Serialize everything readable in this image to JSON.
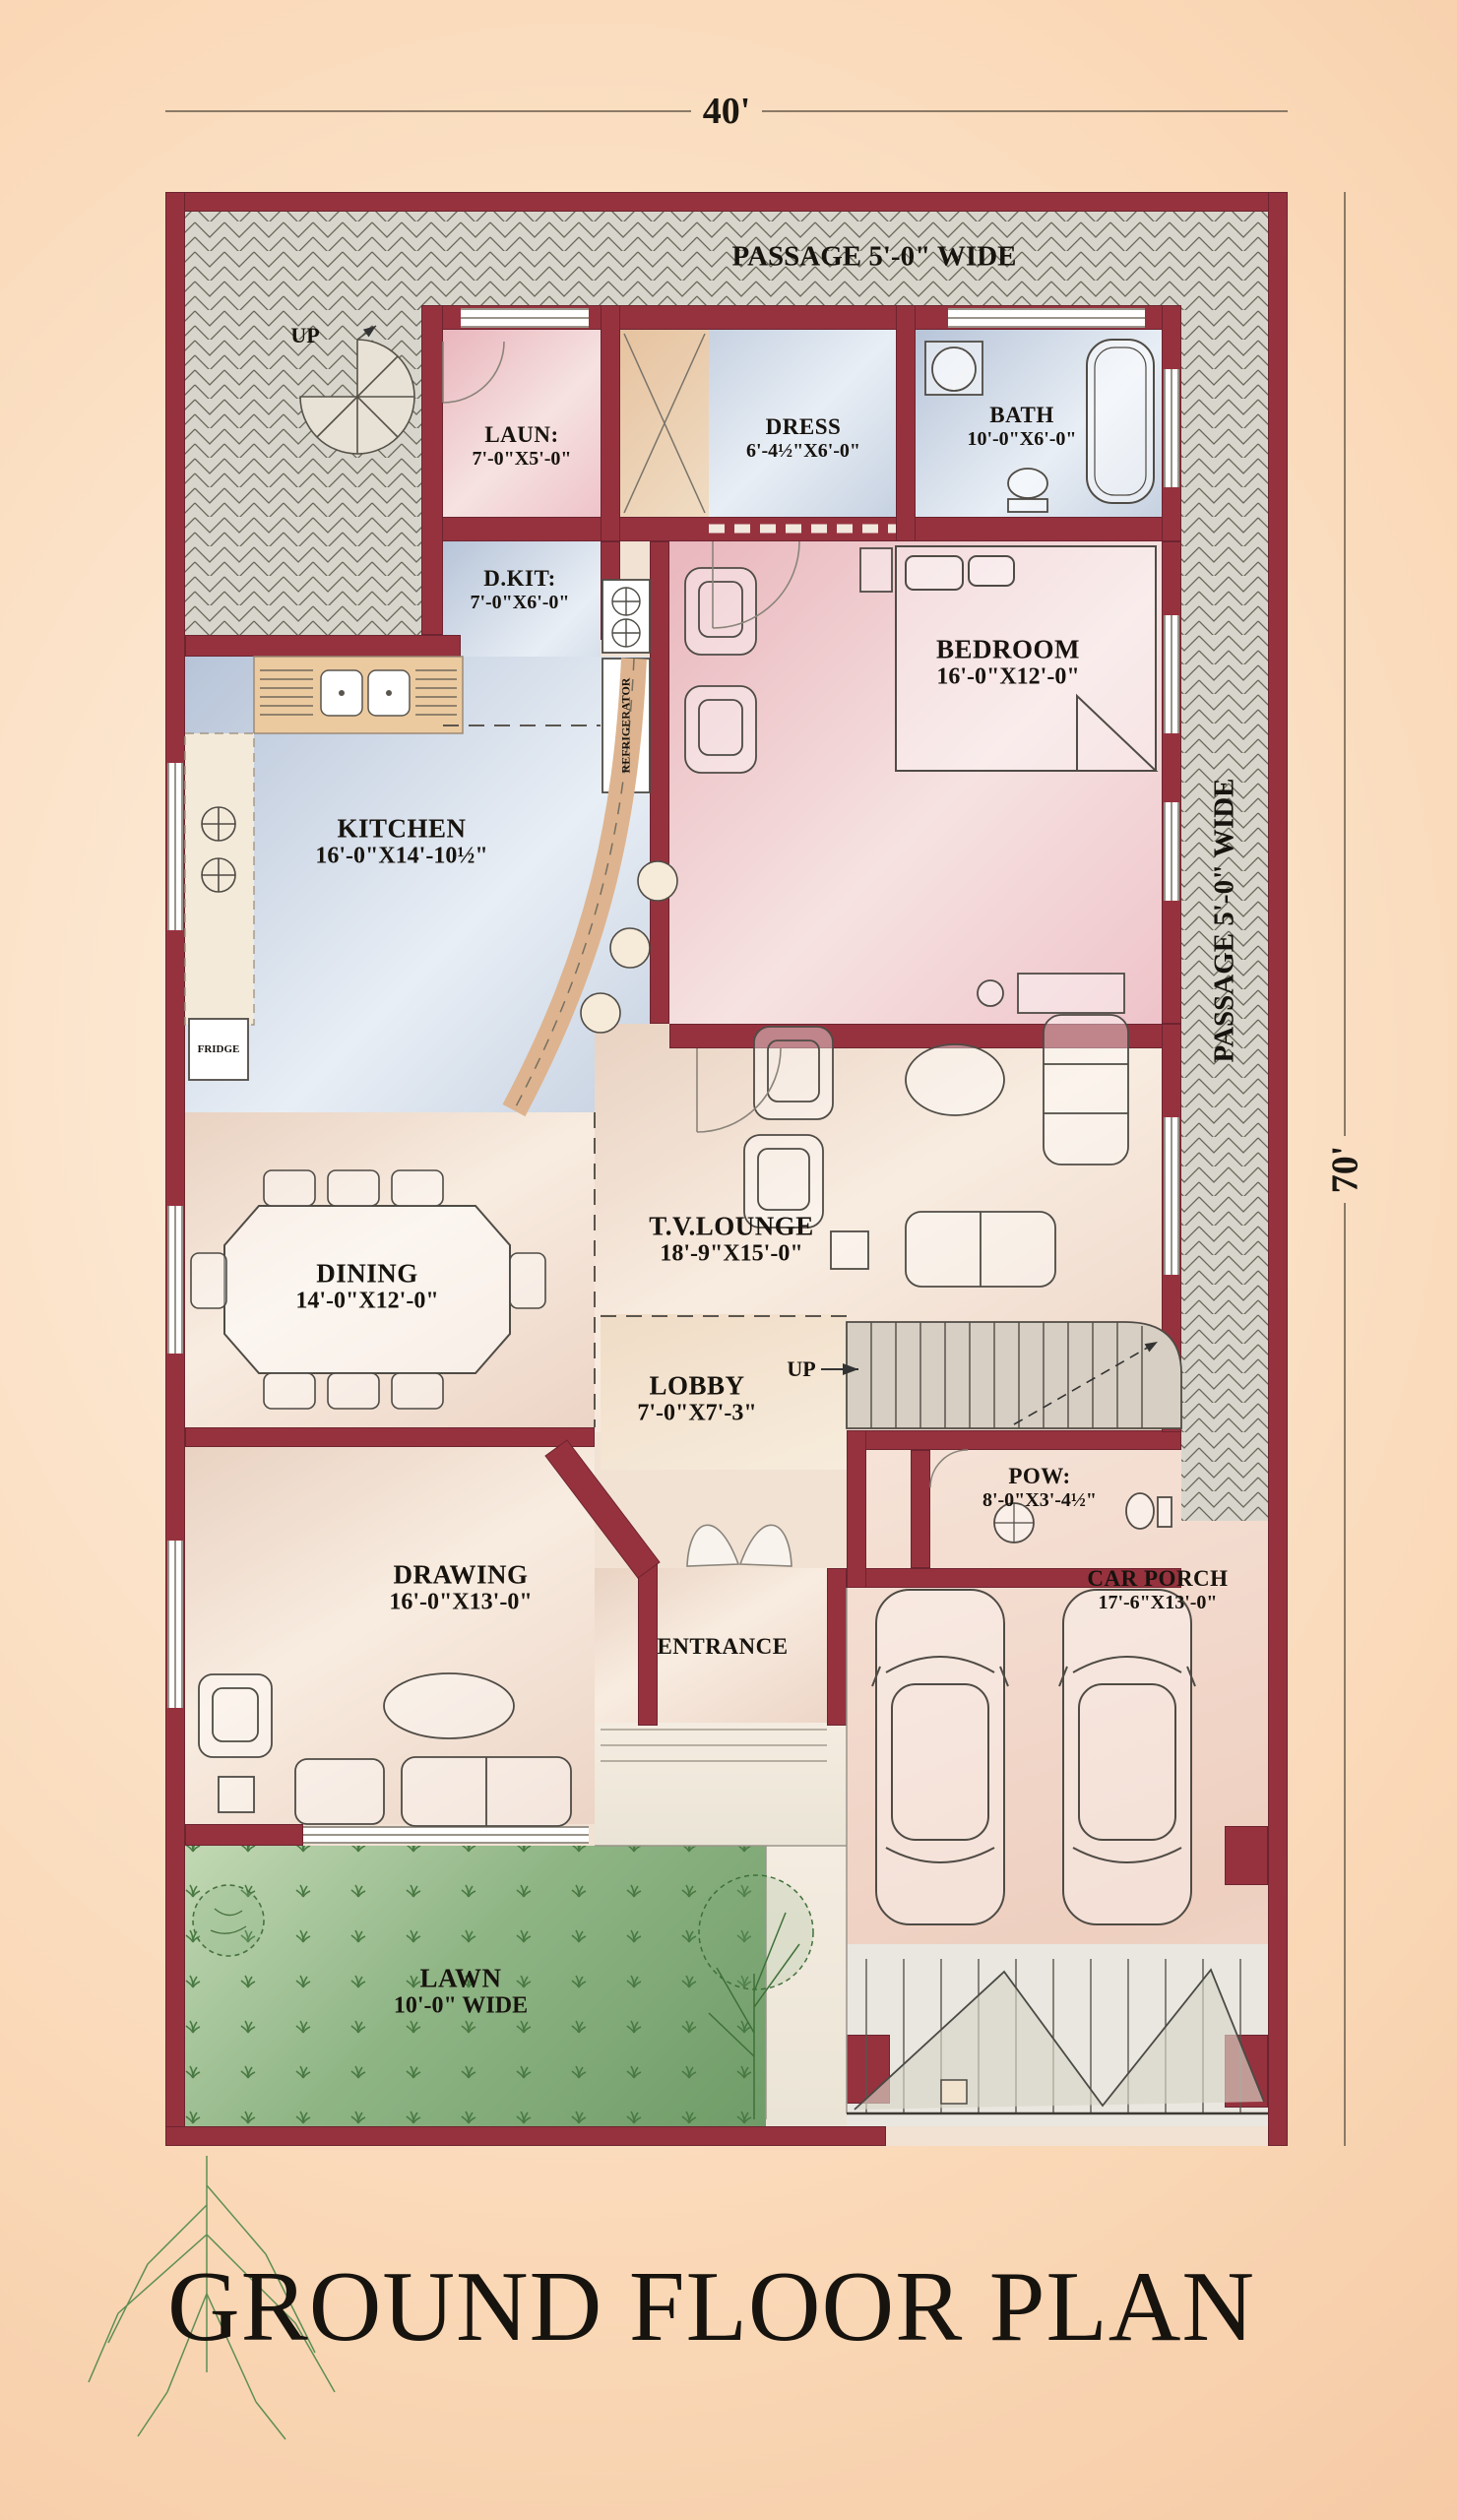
{
  "title": "GROUND FLOOR PLAN",
  "dimensions": {
    "top": "40'",
    "right": "70'"
  },
  "passages": {
    "top": "PASSAGE 5'-0\" WIDE",
    "right": "PASSAGE 5'-0\" WIDE"
  },
  "stairs": {
    "spiral_up": "UP",
    "main_up": "UP"
  },
  "appliances": {
    "refrigerator": "REFRIGERATOR",
    "fridge": "FRIDGE"
  },
  "rooms": {
    "laun": {
      "name": "LAUN:",
      "size": "7'-0\"X5'-0\""
    },
    "dress": {
      "name": "DRESS",
      "size": "6'-4½\"X6'-0\""
    },
    "bath": {
      "name": "BATH",
      "size": "10'-0\"X6'-0\""
    },
    "dkit": {
      "name": "D.KIT:",
      "size": "7'-0\"X6'-0\""
    },
    "bedroom": {
      "name": "BEDROOM",
      "size": "16'-0\"X12'-0\""
    },
    "kitchen": {
      "name": "KITCHEN",
      "size": "16'-0\"X14'-10½\""
    },
    "dining": {
      "name": "DINING",
      "size": "14'-0\"X12'-0\""
    },
    "tv_lounge": {
      "name": "T.V.LOUNGE",
      "size": "18'-9\"X15'-0\""
    },
    "lobby": {
      "name": "LOBBY",
      "size": "7'-0\"X7'-3\""
    },
    "pow": {
      "name": "POW:",
      "size": "8'-0\"X3'-4½\""
    },
    "drawing": {
      "name": "DRAWING",
      "size": "16'-0\"X13'-0\""
    },
    "entrance": {
      "name": "ENTRANCE"
    },
    "car_porch": {
      "name": "CAR PORCH",
      "size": "17'-6\"X13'-0\""
    },
    "lawn": {
      "name": "LAWN",
      "size": "10'-0\" WIDE"
    }
  },
  "colors": {
    "wall": "#96323e",
    "hatch_bg": "#d8d6cc",
    "hatch_line": "#6a665a",
    "room_pink": "#eec3c9",
    "room_blue": "#bcc8da",
    "room_cream": "#f2e4d8",
    "counter_tan": "#e9c49c",
    "lawn_green": "#7fa878",
    "porch": "#f3ddd0",
    "dimension_line": "#8b7a66",
    "title_ink": "#17130e",
    "background_peach": "#fad9b8"
  }
}
